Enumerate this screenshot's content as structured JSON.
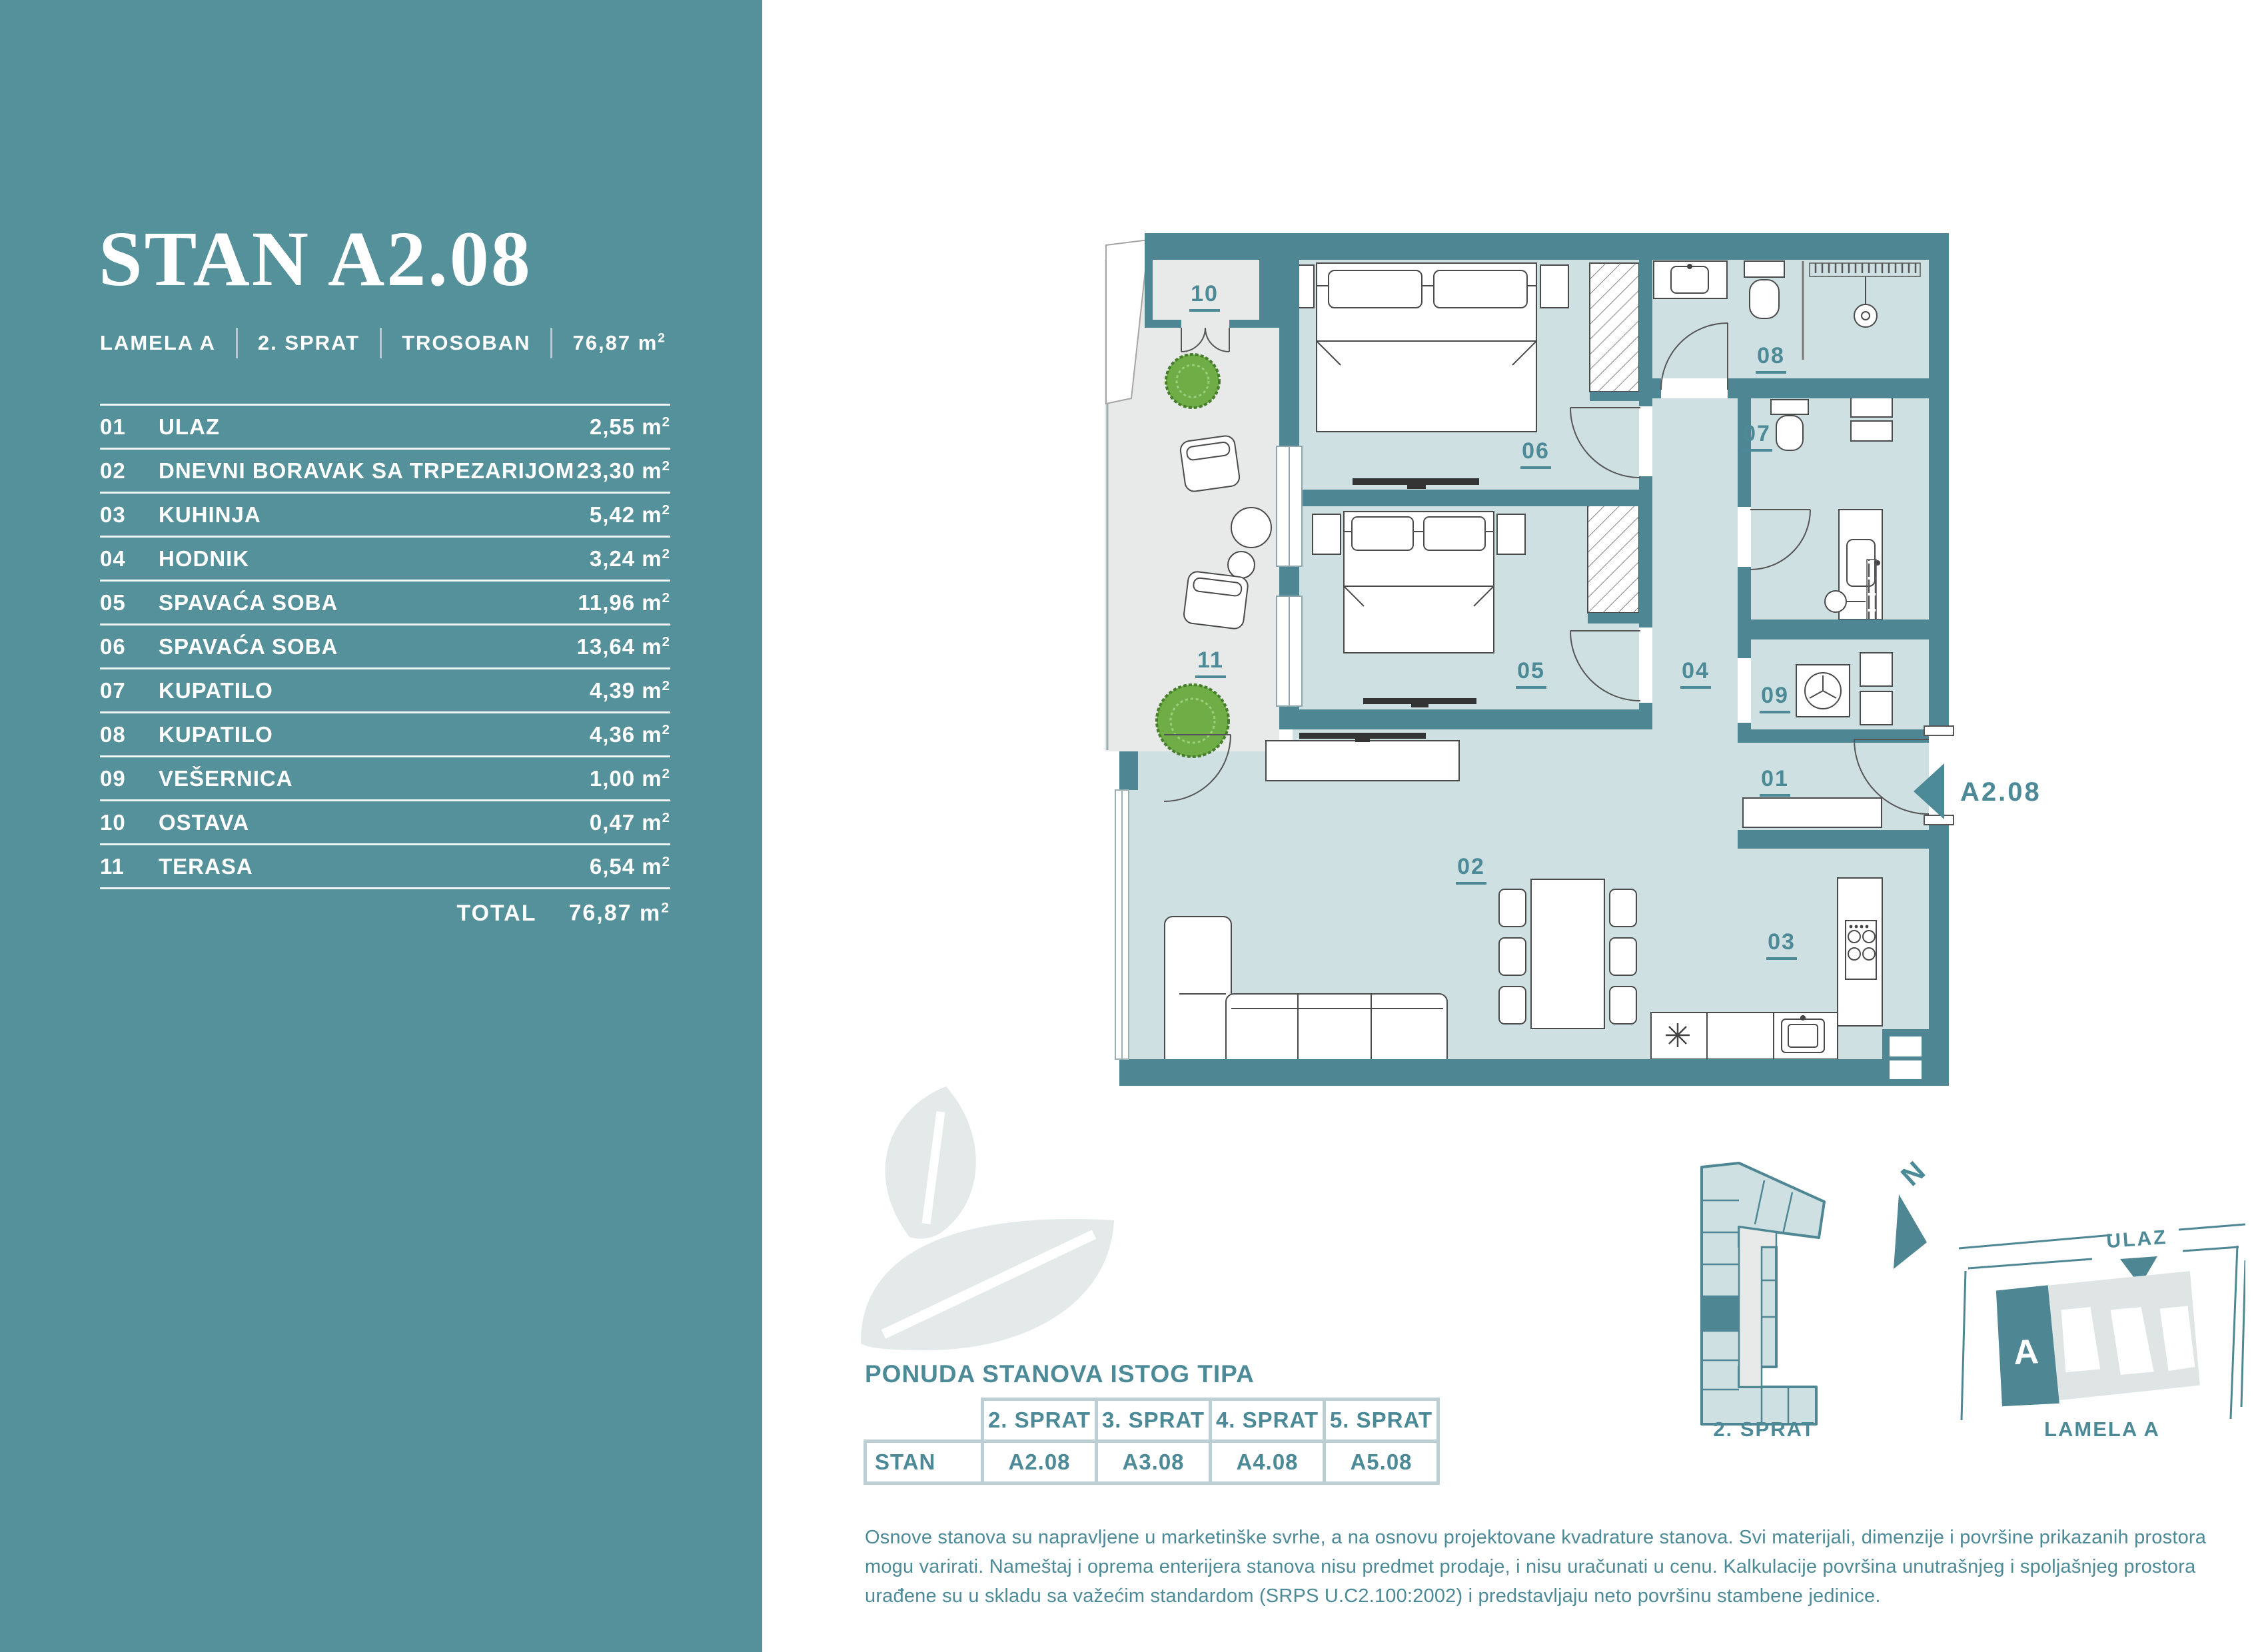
{
  "colors": {
    "sidebar_teal": "#54919a",
    "wall_teal": "#4e8793",
    "room_fill": "#cfe0e2",
    "terrace_fill": "#e8eae9",
    "accent_text": "#4d8a98",
    "table_border": "#bccfd4",
    "leaf_watermark": "#e4e9ea",
    "plant_green": "#6fae46"
  },
  "sidebar": {
    "title": "STAN A2.08",
    "meta": {
      "lamela": "LAMELA A",
      "floor": "2. SPRAT",
      "type": "TROSOBAN",
      "area": "76,87"
    },
    "unit_base": "m",
    "unit_sup": "2",
    "rooms": [
      {
        "num": "01",
        "name": "ULAZ",
        "area": "2,55"
      },
      {
        "num": "02",
        "name": "DNEVNI BORAVAK SA TRPEZARIJOM",
        "area": "23,30"
      },
      {
        "num": "03",
        "name": "KUHINJA",
        "area": "5,42"
      },
      {
        "num": "04",
        "name": "HODNIK",
        "area": "3,24"
      },
      {
        "num": "05",
        "name": "SPAVAĆA SOBA",
        "area": "11,96"
      },
      {
        "num": "06",
        "name": "SPAVAĆA SOBA",
        "area": "13,64"
      },
      {
        "num": "07",
        "name": "KUPATILO",
        "area": "4,39"
      },
      {
        "num": "08",
        "name": "KUPATILO",
        "area": "4,36"
      },
      {
        "num": "09",
        "name": "VEŠERNICA",
        "area": "1,00"
      },
      {
        "num": "10",
        "name": "OSTAVA",
        "area": "0,47"
      },
      {
        "num": "11",
        "name": "TERASA",
        "area": "6,54"
      }
    ],
    "total_label": "TOTAL",
    "total_area": "76,87"
  },
  "plan": {
    "labels": {
      "r01": "01",
      "r02": "02",
      "r03": "03",
      "r04": "04",
      "r05": "05",
      "r06": "06",
      "r07": "07",
      "r08": "08",
      "r09": "09",
      "r10": "10",
      "r11": "11"
    },
    "marker": "A2.08"
  },
  "offer": {
    "title": "PONUDA STANOVA ISTOG TIPA",
    "row_label": "STAN",
    "columns": [
      "2. SPRAT",
      "3. SPRAT",
      "4. SPRAT",
      "5. SPRAT"
    ],
    "values": [
      "A2.08",
      "A3.08",
      "A4.08",
      "A5.08"
    ]
  },
  "minimap": {
    "caption": "2. SPRAT"
  },
  "siteplan": {
    "caption": "LAMELA A",
    "entrance": "ULAZ",
    "building": "A",
    "compass": "N"
  },
  "disclaimer": "Osnove stanova su napravljene u marketinške svrhe, a na osnovu projektovane kvadrature stanova. Svi materijali, dimenzije i površine prikazanih prostora mogu varirati. Nameštaj i oprema enterijera stanova nisu predmet prodaje, i nisu uračunati u cenu. Kalkulacije površina unutrašnjeg i spoljašnjeg prostora urađene su u skladu sa važećim standardom (SRPS U.C2.100:2002) i predstavljaju neto površinu stambene jedinice."
}
